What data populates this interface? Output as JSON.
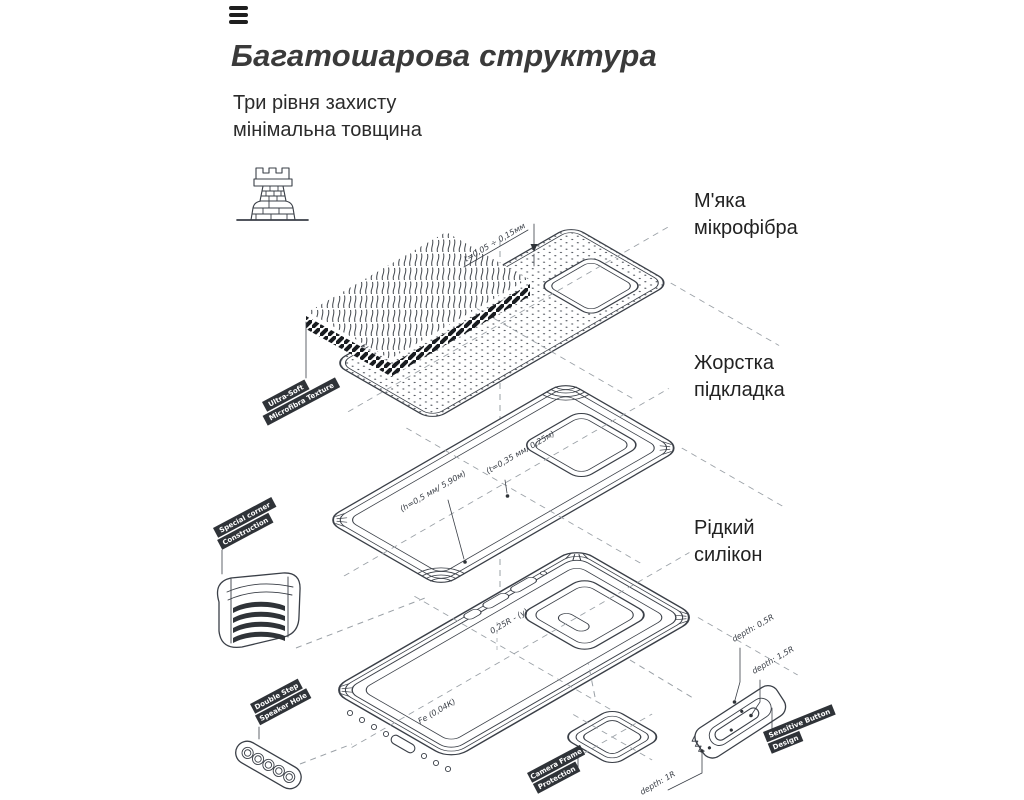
{
  "page": {
    "background": "#ffffff",
    "ink": "#3a3f47",
    "text_dark": "#2b2b2b",
    "ribbon_bg": "#2f3338",
    "ribbon_text": "#ffffff",
    "dash_color": "#9aa0a6"
  },
  "icons": {
    "menu": "hamburger-menu-icon",
    "strength": "fortress-tower-icon"
  },
  "header": {
    "title": "Багатошарова структура",
    "subtitle_lines": [
      "Три рівня захисту",
      "мінімальна товщина"
    ]
  },
  "callouts": {
    "microfiber": {
      "line1": "М'яка",
      "line2": "мікрофібра"
    },
    "hard_lining": {
      "line1": "Жорстка",
      "line2": "підкладка"
    },
    "liquid_silicone": {
      "line1": "Рідкий",
      "line2": "силікон"
    }
  },
  "ribbons": {
    "microfibra": {
      "line1": "Ultra-Soft",
      "line2": "Microfibra Texture"
    },
    "corner": {
      "line1": "Special corner",
      "line2": "Construction"
    },
    "speaker": {
      "line1": "Double Step",
      "line2": "Speaker Hole"
    },
    "camera": {
      "line1": "Camera Frame",
      "line2": "Protection"
    },
    "button": {
      "line1": "Sensitive Button",
      "line2": "Design"
    }
  },
  "dimensions": {
    "sheet_thickness": "t=0,05 ÷ 0,15мм",
    "lining_thickness": "(t=0,35 мм/ 0,25м)",
    "lining_height": "(h=0,5 мм/ 5,90м)",
    "frame_radius": "0,25R - (у)",
    "case_marking": "Fe (0,04К)",
    "button_depth_outer": "depth: 0,5R",
    "button_depth_inner": "depth: 1,5R",
    "button_depth_side": "depth: 1R"
  }
}
